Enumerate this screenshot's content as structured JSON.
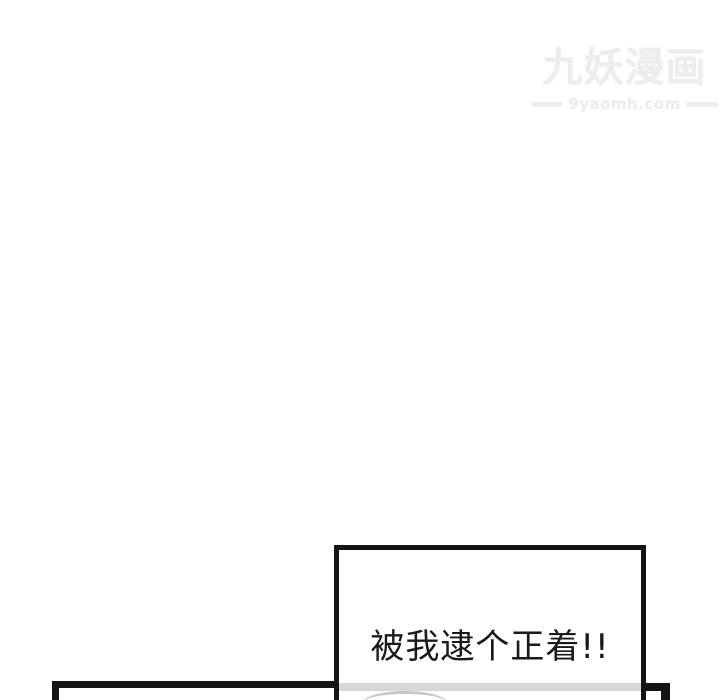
{
  "watermark": {
    "title": "九妖漫画",
    "url": "9yaomh.com"
  },
  "caption_panel": {
    "text": "被我逮个正着!!"
  },
  "colors": {
    "background": "#ffffff",
    "panel_border": "#141414",
    "gray_band": "#d7d7d7",
    "arc": "#b5b5b5",
    "watermark": "#efecec"
  }
}
